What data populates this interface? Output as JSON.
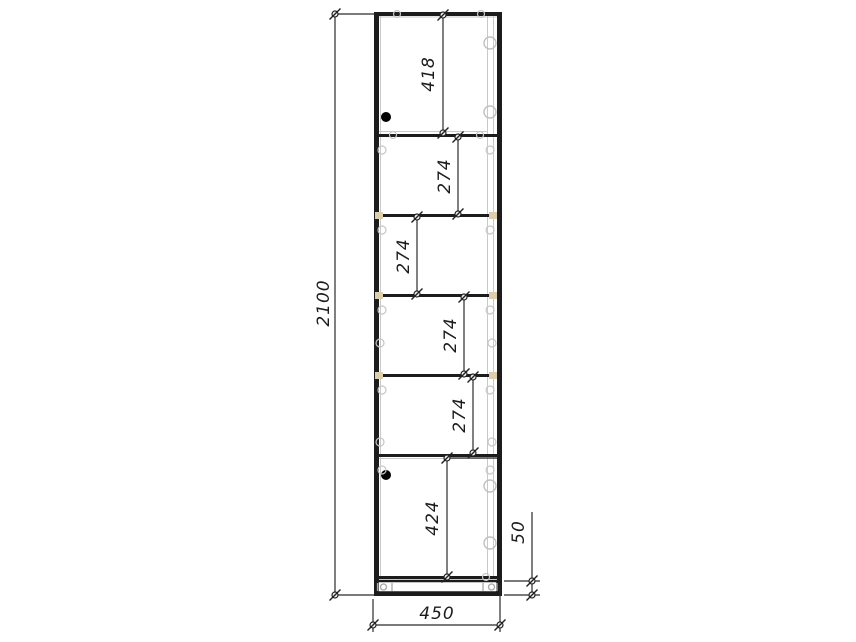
{
  "drawing": {
    "dimensions": {
      "overall_height_mm": "2100",
      "width_mm": "450",
      "top_door_height_mm": "418",
      "shelf_spacing_mm": [
        "274",
        "274",
        "274",
        "274"
      ],
      "bottom_door_height_mm": "424",
      "plinth_height_mm": "50"
    },
    "colors": {
      "line": "#1c1c1c",
      "dimension_line": "#2b2b2b",
      "light_detail": "#c6c6c6",
      "shelf_support": "#dccfae",
      "handle": "#000000",
      "background": "#ffffff"
    }
  }
}
